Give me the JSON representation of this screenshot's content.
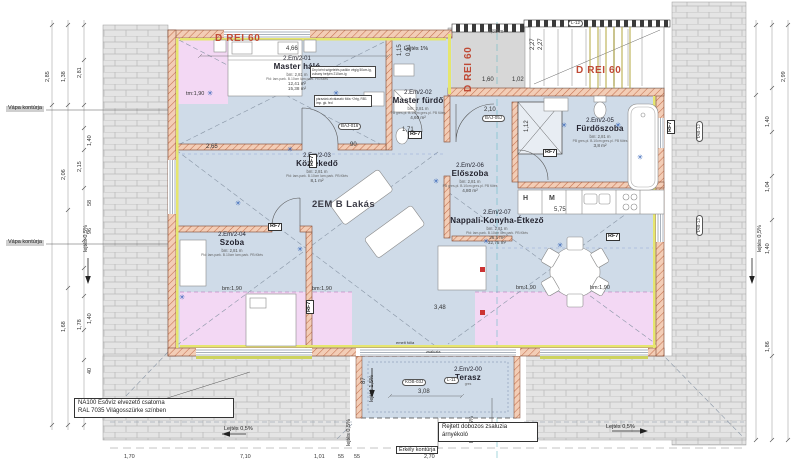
{
  "apartment": {
    "label": "2EM B Lakás"
  },
  "rooms": [
    {
      "num": "2.Em/2-01",
      "name": "Master háló",
      "height": "bm: 2,81 m",
      "spec": "Pld: lam.park. B.10cm lam.park. PB fűtés",
      "area": "12,41 m²",
      "area2": "15,38 m²",
      "x": 297,
      "y": 56
    },
    {
      "num": "2.Em/2-02",
      "name": "Master fürdő",
      "height": "bm: 2,81 m",
      "spec": "PB gres.pl. B.10cm gres.pl. PB fűtés",
      "area": "4,60 m²",
      "area2": "",
      "x": 418,
      "y": 90
    },
    {
      "num": "2.Em/2-03",
      "name": "Közlekedő",
      "height": "bm: 2,81 m",
      "spec": "Pld: lam.park. B.10cm lam.park. PB fűtés",
      "area": "8,1 m²",
      "area2": "",
      "x": 317,
      "y": 153
    },
    {
      "num": "2.Em/2-04",
      "name": "Szoba",
      "height": "bm: 2,81 m",
      "spec": "Pld: lam.park. B.10cm lam.park. PB fűtés",
      "area": "",
      "area2": "",
      "x": 232,
      "y": 232
    },
    {
      "num": "2.Em/2-05",
      "name": "Fürdőszoba",
      "height": "bm: 2,81 m",
      "spec": "PB gres.pl. B.10cm gres.pl. PB fűtés",
      "area": "3,8 m²",
      "area2": "",
      "x": 600,
      "y": 118
    },
    {
      "num": "2.Em/2-06",
      "name": "Előszoba",
      "height": "bm: 2,81 m",
      "spec": "PB gres.pl. B.10cm gres.pl. PB fűtés",
      "area": "4,80 m²",
      "area2": "",
      "x": 470,
      "y": 163
    },
    {
      "num": "2.Em/2-07",
      "name": "Nappali-Konyha-Étkező",
      "height": "bm: 2,81 m",
      "spec": "Pld: lam.park. B.10cm lam.park. PB fűtés",
      "area": "26,5 m²",
      "area2": "32,75 m²",
      "x": 497,
      "y": 210
    },
    {
      "num": "2.Em/2-00",
      "name": "Terasz",
      "height": "",
      "spec": "gres",
      "area": "",
      "area2": "",
      "x": 468,
      "y": 367
    }
  ],
  "fire_labels": [
    {
      "t": "D REI 60",
      "x": 215,
      "y": 34
    },
    {
      "t": "D REI 60",
      "x": 464,
      "y": 92,
      "rot": -90
    },
    {
      "t": "D REI 60",
      "x": 576,
      "y": 66
    }
  ],
  "notes": {
    "gutter_line1": "NA100 Esővíz elvezető csatorna",
    "gutter_line2": "RAL 7035 Világosszürke színben",
    "shutter_line1": "Rejtett dobozos zsaluzia",
    "shutter_line2": "árnyékoló",
    "balcony": "Erkély kontúrja",
    "halo_note1": "Dny ként szigetelés padlón végig 50cm-ig, zuhany helyén 210cm-ig",
    "halo_note2": "párazáró-elválasztó fólia +2rtg, RB1 imp. gk. fed",
    "roof_area": "4,80 m²"
  },
  "valley_labels": [
    {
      "t": "Vápa kontúrja",
      "x": 6,
      "y": 106
    },
    {
      "t": "Vápa kontúrja",
      "x": 6,
      "y": 240
    }
  ],
  "slope_labels": [
    {
      "t": "Lejtés 1%",
      "x": 404,
      "y": 47
    },
    {
      "t": "lejtés 0,5%",
      "x": 84,
      "y": 252,
      "rot": -90
    },
    {
      "t": "lejtés 0,5%",
      "x": 758,
      "y": 252,
      "rot": -90
    },
    {
      "t": "Lejtés 0,5%",
      "x": 224,
      "y": 427
    },
    {
      "t": "Lejtés 0,5%",
      "x": 486,
      "y": 427
    },
    {
      "t": "Lejtés 0,5%",
      "x": 606,
      "y": 425
    },
    {
      "t": "lejtés 0,5%",
      "x": 347,
      "y": 446,
      "rot": -90
    },
    {
      "t": "lejtés 0,5%",
      "x": 470,
      "y": 443,
      "rot": -90
    },
    {
      "t": "lejtés 1,5%",
      "x": 370,
      "y": 402,
      "rot": -90
    }
  ],
  "bm_labels": [
    {
      "t": "tm:1,90",
      "x": 186,
      "y": 92
    },
    {
      "t": "bm:1,90",
      "x": 222,
      "y": 287
    },
    {
      "t": "bm:1,90",
      "x": 312,
      "y": 287
    },
    {
      "t": "bm:1,90",
      "x": 516,
      "y": 286
    },
    {
      "t": "bm:1,90",
      "x": 590,
      "y": 286
    }
  ],
  "codes": [
    {
      "t": "BAJ-016",
      "x": 338,
      "y": 123
    },
    {
      "t": "BAJ-05J",
      "x": 482,
      "y": 115
    },
    {
      "t": "KOB-03J",
      "x": 402,
      "y": 379
    },
    {
      "t": "TAB-1J",
      "x": 696,
      "y": 142,
      "rot": -90
    },
    {
      "t": "TAB-1J",
      "x": 696,
      "y": 236,
      "rot": -90
    },
    {
      "t": "L-12",
      "x": 568,
      "y": 20
    },
    {
      "t": "L-11",
      "x": 444,
      "y": 377
    }
  ],
  "rf_labels": [
    {
      "t": "RF7",
      "x": 309,
      "y": 168,
      "rot": -90
    },
    {
      "t": "RF7",
      "x": 408,
      "y": 131
    },
    {
      "t": "RF7",
      "x": 543,
      "y": 149
    },
    {
      "t": "RF7",
      "x": 306,
      "y": 314,
      "rot": -90
    },
    {
      "t": "RF7",
      "x": 667,
      "y": 134,
      "rot": -90
    },
    {
      "t": "RF7",
      "x": 606,
      "y": 233
    },
    {
      "t": "RF7",
      "x": 268,
      "y": 223
    }
  ],
  "dims_plan": [
    {
      "t": "4,66",
      "x": 286,
      "y": 46
    },
    {
      "t": "2,65",
      "x": 206,
      "y": 144
    },
    {
      "t": "90",
      "x": 350,
      "y": 142
    },
    {
      "t": "1,71",
      "x": 402,
      "y": 127
    },
    {
      "t": "2,10",
      "x": 484,
      "y": 107
    },
    {
      "t": "1,12",
      "x": 524,
      "y": 132,
      "rot": -90
    },
    {
      "t": "1,60",
      "x": 482,
      "y": 77
    },
    {
      "t": "1,02",
      "x": 512,
      "y": 77
    },
    {
      "t": "5,75",
      "x": 554,
      "y": 207
    },
    {
      "t": "3,48",
      "x": 434,
      "y": 305
    },
    {
      "t": "3,08",
      "x": 418,
      "y": 389
    },
    {
      "t": "87",
      "x": 361,
      "y": 384,
      "rot": -90
    },
    {
      "t": "1,15",
      "x": 397,
      "y": 56,
      "rot": -90
    },
    {
      "t": "0,91",
      "x": 406,
      "y": 56,
      "rot": -90
    },
    {
      "t": "2,27",
      "x": 530,
      "y": 50,
      "rot": -90
    },
    {
      "t": "2,27",
      "x": 538,
      "y": 50,
      "rot": -90
    }
  ],
  "dims_left": [
    {
      "t": "2,85",
      "x": 46,
      "y": 82,
      "rot": -90
    },
    {
      "t": "1,38",
      "x": 62,
      "y": 82,
      "rot": -90
    },
    {
      "t": "2,81",
      "x": 78,
      "y": 78,
      "rot": -90
    },
    {
      "t": "2,06",
      "x": 62,
      "y": 180,
      "rot": -90
    },
    {
      "t": "2,15",
      "x": 78,
      "y": 172,
      "rot": -90
    },
    {
      "t": "1,40",
      "x": 88,
      "y": 146,
      "rot": -90
    },
    {
      "t": "58",
      "x": 88,
      "y": 206,
      "rot": -90
    },
    {
      "t": "96",
      "x": 88,
      "y": 234,
      "rot": -90
    },
    {
      "t": "1,68",
      "x": 62,
      "y": 332,
      "rot": -90
    },
    {
      "t": "1,78",
      "x": 78,
      "y": 330,
      "rot": -90
    },
    {
      "t": "1,40",
      "x": 88,
      "y": 324,
      "rot": -90
    },
    {
      "t": "40",
      "x": 88,
      "y": 374,
      "rot": -90
    }
  ],
  "dims_right": [
    {
      "t": "2,99",
      "x": 782,
      "y": 82,
      "rot": -90
    },
    {
      "t": "1,40",
      "x": 766,
      "y": 127,
      "rot": -90
    },
    {
      "t": "1,04",
      "x": 766,
      "y": 192,
      "rot": -90
    },
    {
      "t": "1,40",
      "x": 766,
      "y": 254,
      "rot": -90
    },
    {
      "t": "1,86",
      "x": 766,
      "y": 352,
      "rot": -90
    }
  ],
  "dims_bottom": [
    {
      "t": "1,70",
      "x": 124,
      "y": 455
    },
    {
      "t": "7,10",
      "x": 240,
      "y": 455
    },
    {
      "t": "1,01",
      "x": 314,
      "y": 455
    },
    {
      "t": "55",
      "x": 338,
      "y": 455
    },
    {
      "t": "55",
      "x": 354,
      "y": 455
    },
    {
      "t": "2,70",
      "x": 424,
      "y": 455
    }
  ],
  "terrace_notes": [
    {
      "t": "emelt fólia",
      "x": 396,
      "y": 341
    },
    {
      "t": "zsaluzia",
      "x": 426,
      "y": 350
    }
  ],
  "kitchen": {
    "fridge": "H",
    "appliance": "M"
  },
  "stars": [
    {
      "x": 290,
      "y": 150
    },
    {
      "x": 182,
      "y": 298
    },
    {
      "x": 336,
      "y": 94
    },
    {
      "x": 436,
      "y": 182
    },
    {
      "x": 486,
      "y": 242
    },
    {
      "x": 560,
      "y": 246
    },
    {
      "x": 618,
      "y": 126
    },
    {
      "x": 564,
      "y": 126
    },
    {
      "x": 238,
      "y": 204
    },
    {
      "x": 210,
      "y": 94
    },
    {
      "x": 640,
      "y": 158
    },
    {
      "x": 300,
      "y": 250
    }
  ]
}
